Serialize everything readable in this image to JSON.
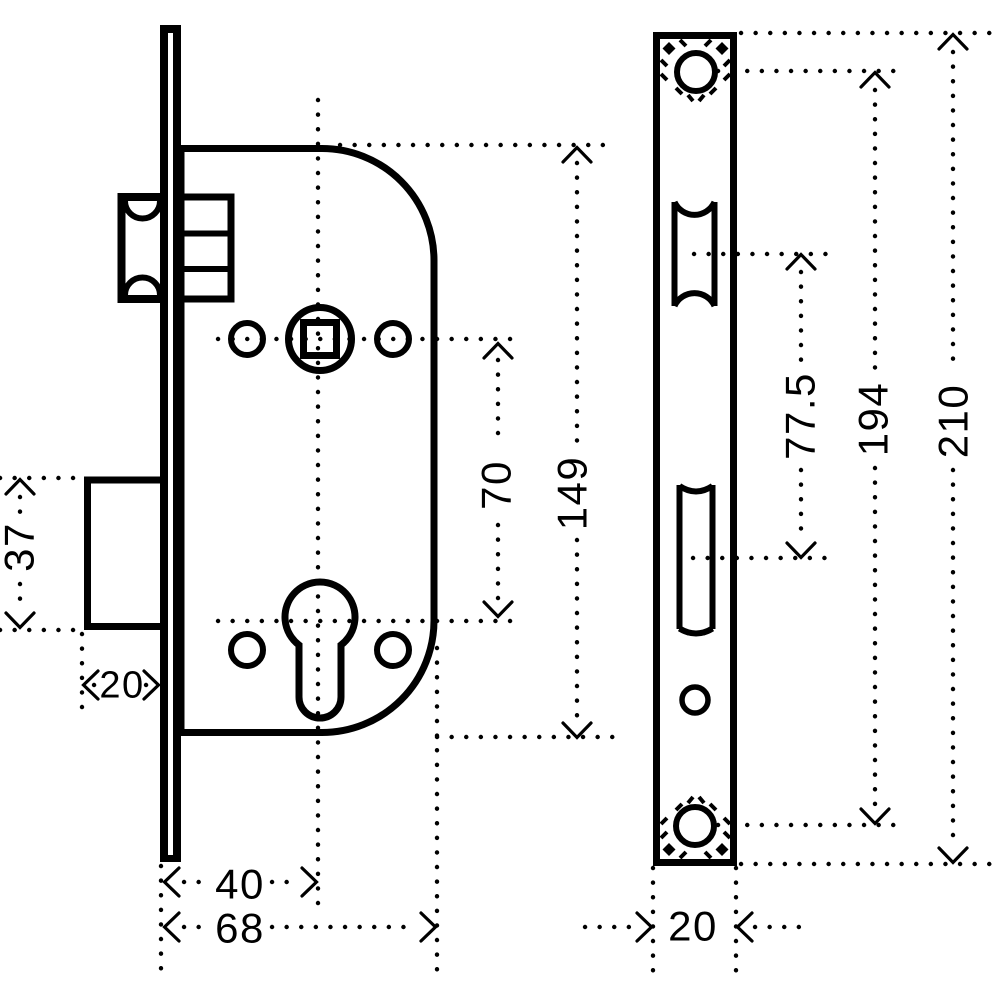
{
  "drawing": {
    "background_color": "#ffffff",
    "line_color": "#000000",
    "side_view": {
      "name": "mortise-lock-side-view",
      "dims": {
        "deadbolt_height": "37",
        "deadbolt_throw": "20",
        "spindle_to_cylinder": "70",
        "case_height": "149",
        "backset": "40",
        "case_depth": "68"
      }
    },
    "faceplate_view": {
      "name": "faceplate-front-view",
      "dims": {
        "latch_to_deadbolt_centers": "77.5",
        "screw_hole_centers": "194",
        "faceplate_height": "210",
        "faceplate_width": "20"
      }
    }
  }
}
